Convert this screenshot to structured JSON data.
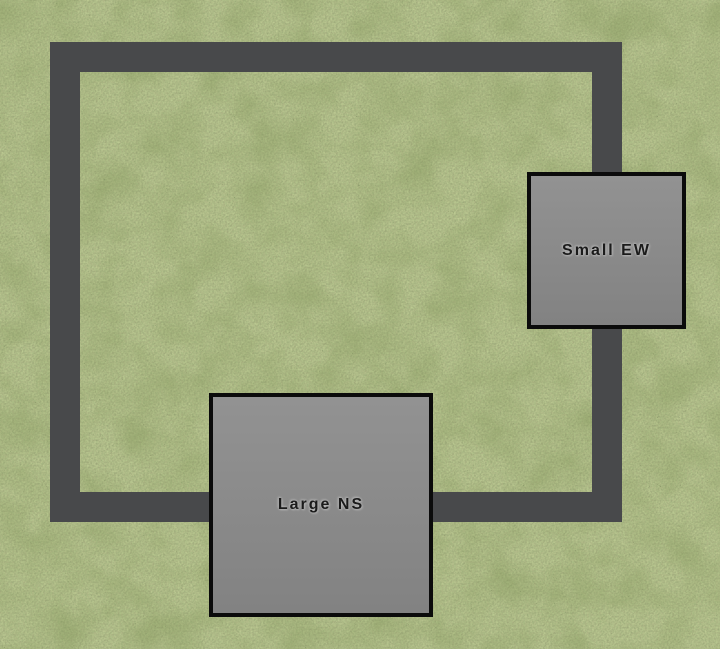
{
  "scene": {
    "colors": {
      "grass": "#6c7a3e",
      "road": "#48494b",
      "building_fill": "#8b8b8b",
      "building_border": "#0b0b0b",
      "label_text": "#1b1b1b"
    },
    "buildings": [
      {
        "label": "Small EW"
      },
      {
        "label": "Large NS"
      }
    ]
  }
}
